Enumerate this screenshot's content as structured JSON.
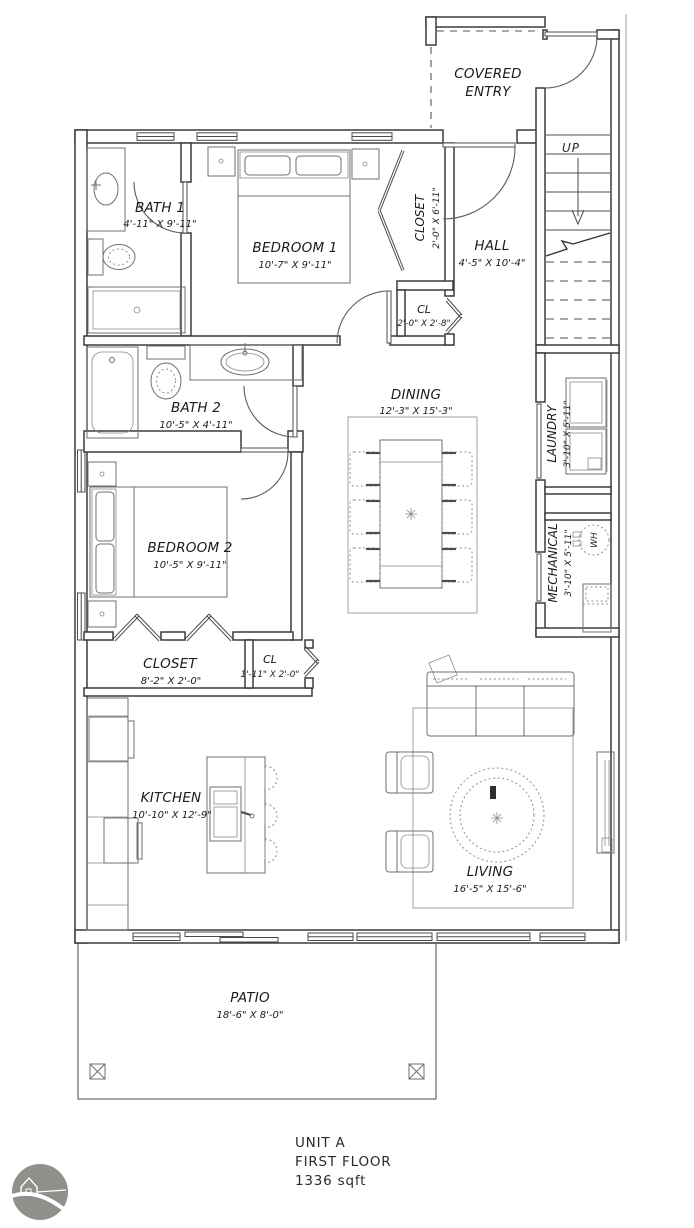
{
  "plan": {
    "covered_entry": {
      "line1": "COVERED",
      "line2": "ENTRY"
    },
    "stairs": {
      "up": "UP"
    },
    "hall": {
      "name": "HALL",
      "dims": "4'-5\" X 10'-4\""
    },
    "bath1": {
      "name": "BATH 1",
      "dims": "4'-11\" X 9'-11\""
    },
    "bedroom1": {
      "name": "BEDROOM 1",
      "dims": "10'-7\" X 9'-11\""
    },
    "closet1": {
      "name": "CLOSET",
      "dims": "2'-0\" X 6'-11\""
    },
    "cl1": {
      "name": "CL",
      "dims": "2'-0\" X 2'-8\""
    },
    "bath2": {
      "name": "BATH 2",
      "dims": "10'-5\" X 4'-11\""
    },
    "dining": {
      "name": "DINING",
      "dims": "12'-3\" X 15'-3\""
    },
    "laundry": {
      "name": "LAUNDRY",
      "dims": "3'-10\" X 5'-11\""
    },
    "mechanical": {
      "name": "MECHANICAL",
      "dims": "3'-10\" X 5'-11\""
    },
    "water_heater": {
      "label": "WH"
    },
    "bedroom2": {
      "name": "BEDROOM 2",
      "dims": "10'-5\" X 9'-11\""
    },
    "closet2": {
      "name": "CLOSET",
      "dims": "8'-2\" X 2'-0\""
    },
    "cl2": {
      "name": "CL",
      "dims": "1'-11\" X 2'-0\""
    },
    "kitchen": {
      "name": "KITCHEN",
      "dims": "10'-10\" X 12'-9\""
    },
    "living": {
      "name": "LIVING",
      "dims": "16'-5\" X 15'-6\""
    },
    "patio": {
      "name": "PATIO",
      "dims": "18'-6\" X 8'-0\""
    }
  },
  "footer": {
    "unit": "UNIT A",
    "floor": "FIRST FLOOR",
    "area": "1336 sqft"
  },
  "colors": {
    "ink": "#3c3c3c",
    "furniture": "#6f6f6f",
    "overhang": "#b5b5b5",
    "logo": "#8f8f8c",
    "paper": "#ffffff"
  }
}
